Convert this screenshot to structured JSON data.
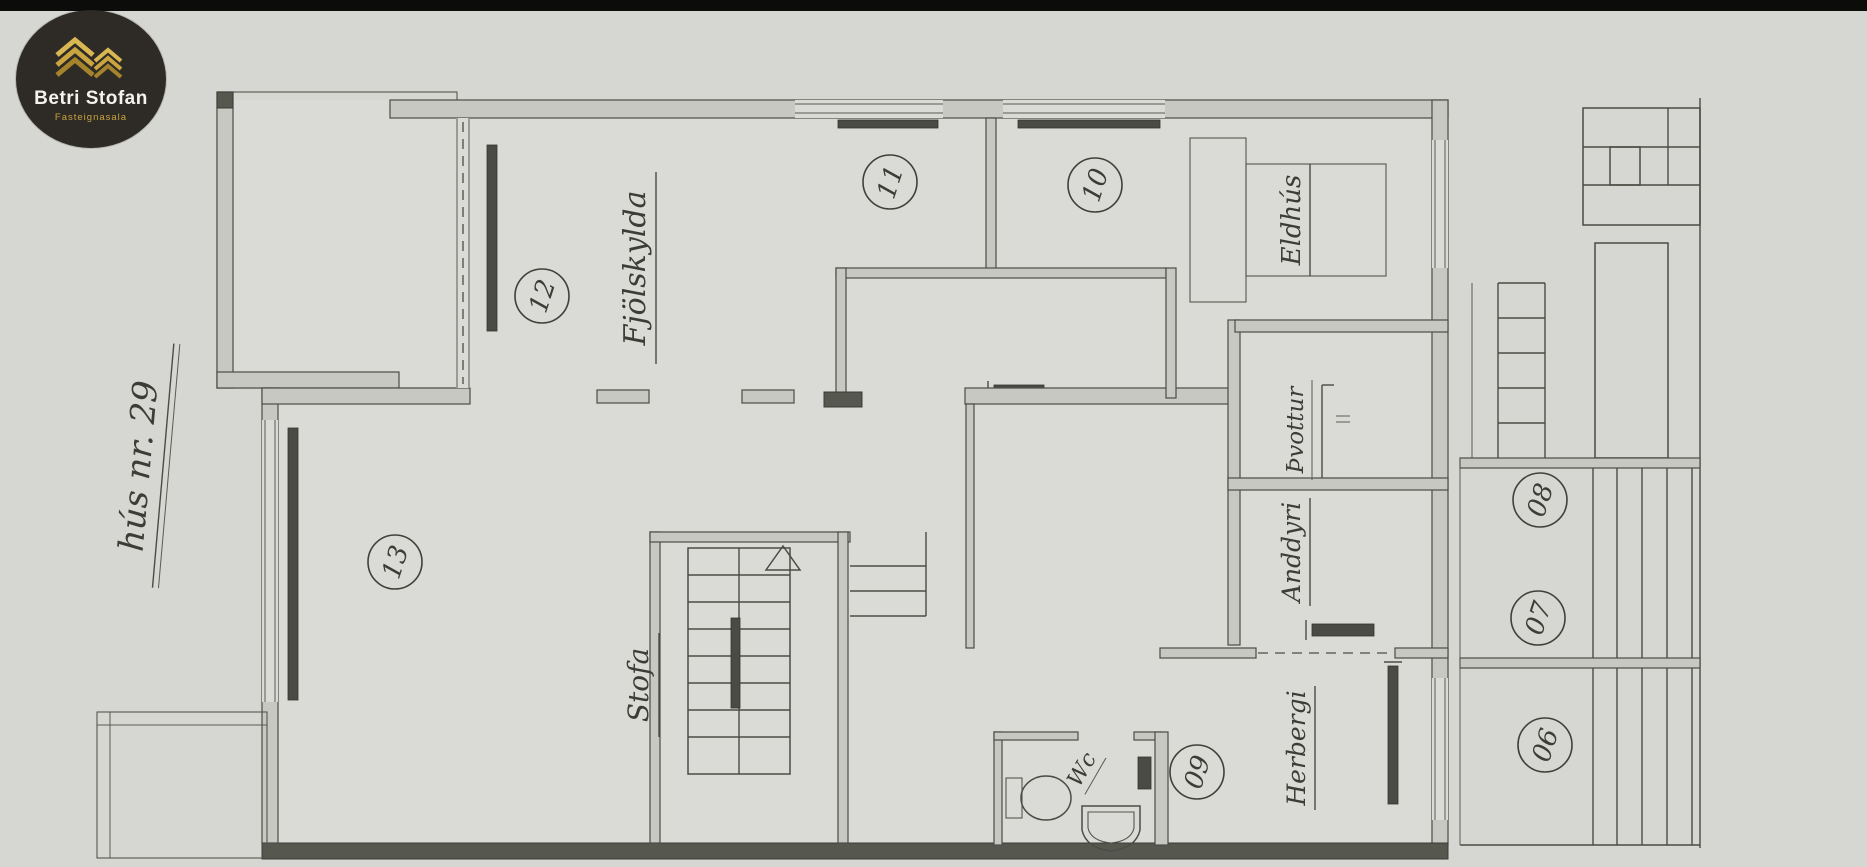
{
  "logo": {
    "brand": "Betri Stofan",
    "tagline": "Fasteignasala"
  },
  "plan": {
    "house_number_label": "hús nr. 29",
    "room_labels": {
      "fjolskylda": "Fjölskylda",
      "stofa": "Stofa",
      "eldhus": "Eldhús",
      "thvottur": "Þvottur",
      "anddyri": "Anddyri",
      "herbergi": "Herbergi",
      "wc": "Wc"
    },
    "room_numbers": {
      "r06": "06",
      "r07": "07",
      "r08": "08",
      "r09": "09",
      "r10": "10",
      "r11": "11",
      "r12": "12",
      "r13": "13"
    }
  },
  "colors": {
    "paper": "#d6d7d2",
    "ink": "#3c3d36",
    "wall_fill": "#c7c8c2",
    "radiator": "#4a4b44",
    "top_bar": "#0c0c0a",
    "logo_background": "#2e2b27",
    "logo_gold": "#c9a43f"
  }
}
